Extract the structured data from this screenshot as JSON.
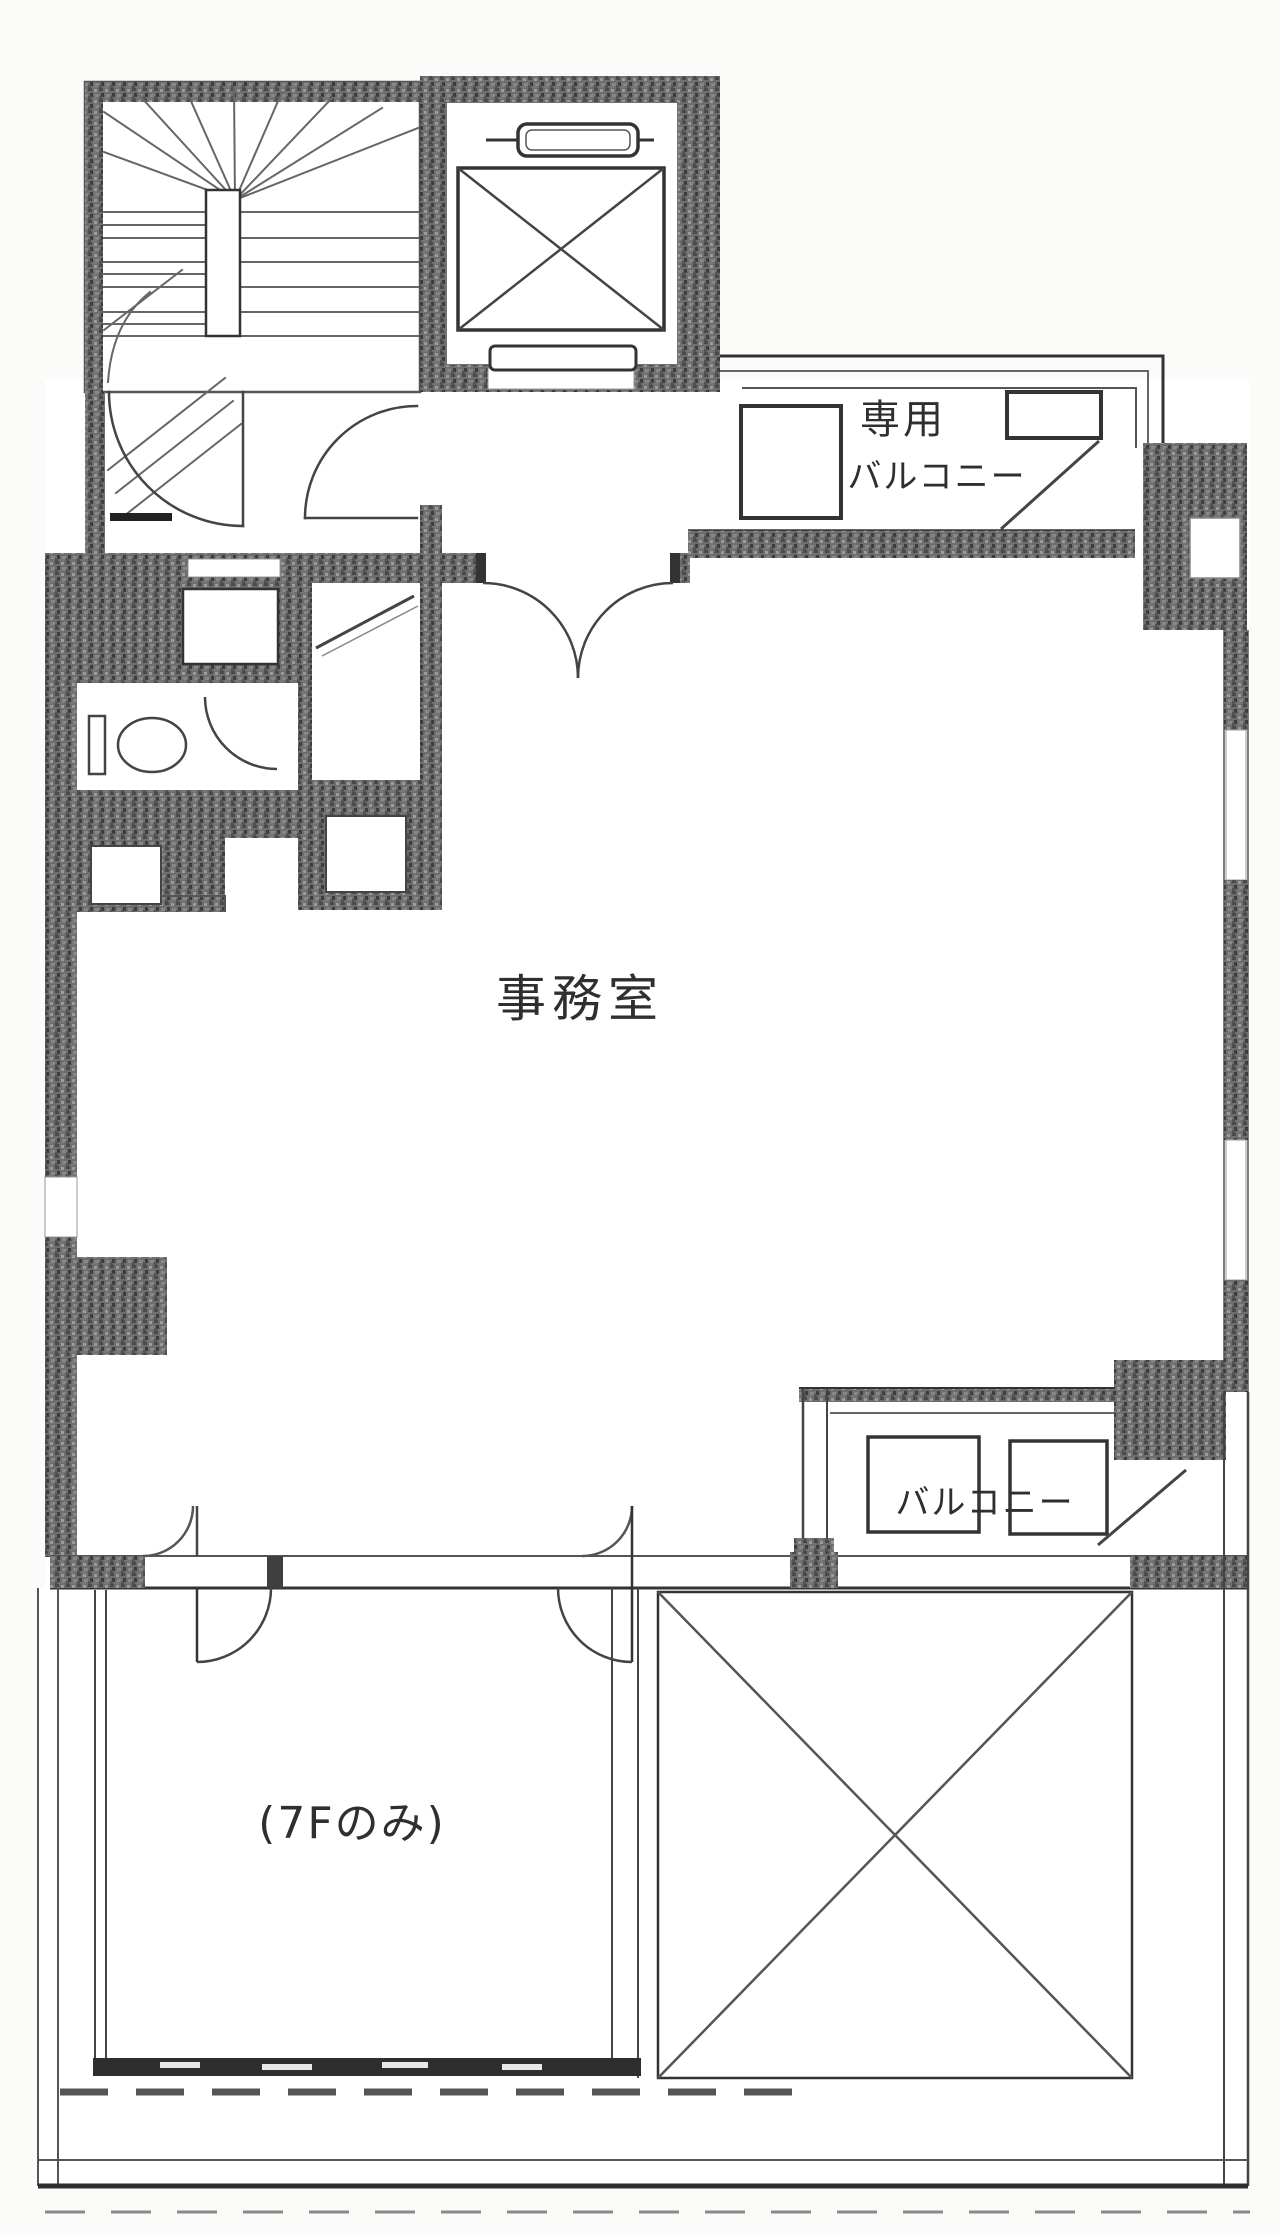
{
  "document": {
    "kind": "floor-plan",
    "language": "ja"
  },
  "rooms": {
    "office": {
      "label": "事務室"
    },
    "private_balcony": {
      "label_line1": "専用",
      "label_line2": "バルコニー"
    },
    "balcony": {
      "label": "バルコニー"
    },
    "bottom_room": {
      "label": "(7Fのみ)"
    }
  },
  "colors": {
    "paper": "#fbfbf9",
    "wall_dark": "#3a3a3a",
    "wall_speckle": "#6e6e6e",
    "line_gray": "#555555"
  }
}
